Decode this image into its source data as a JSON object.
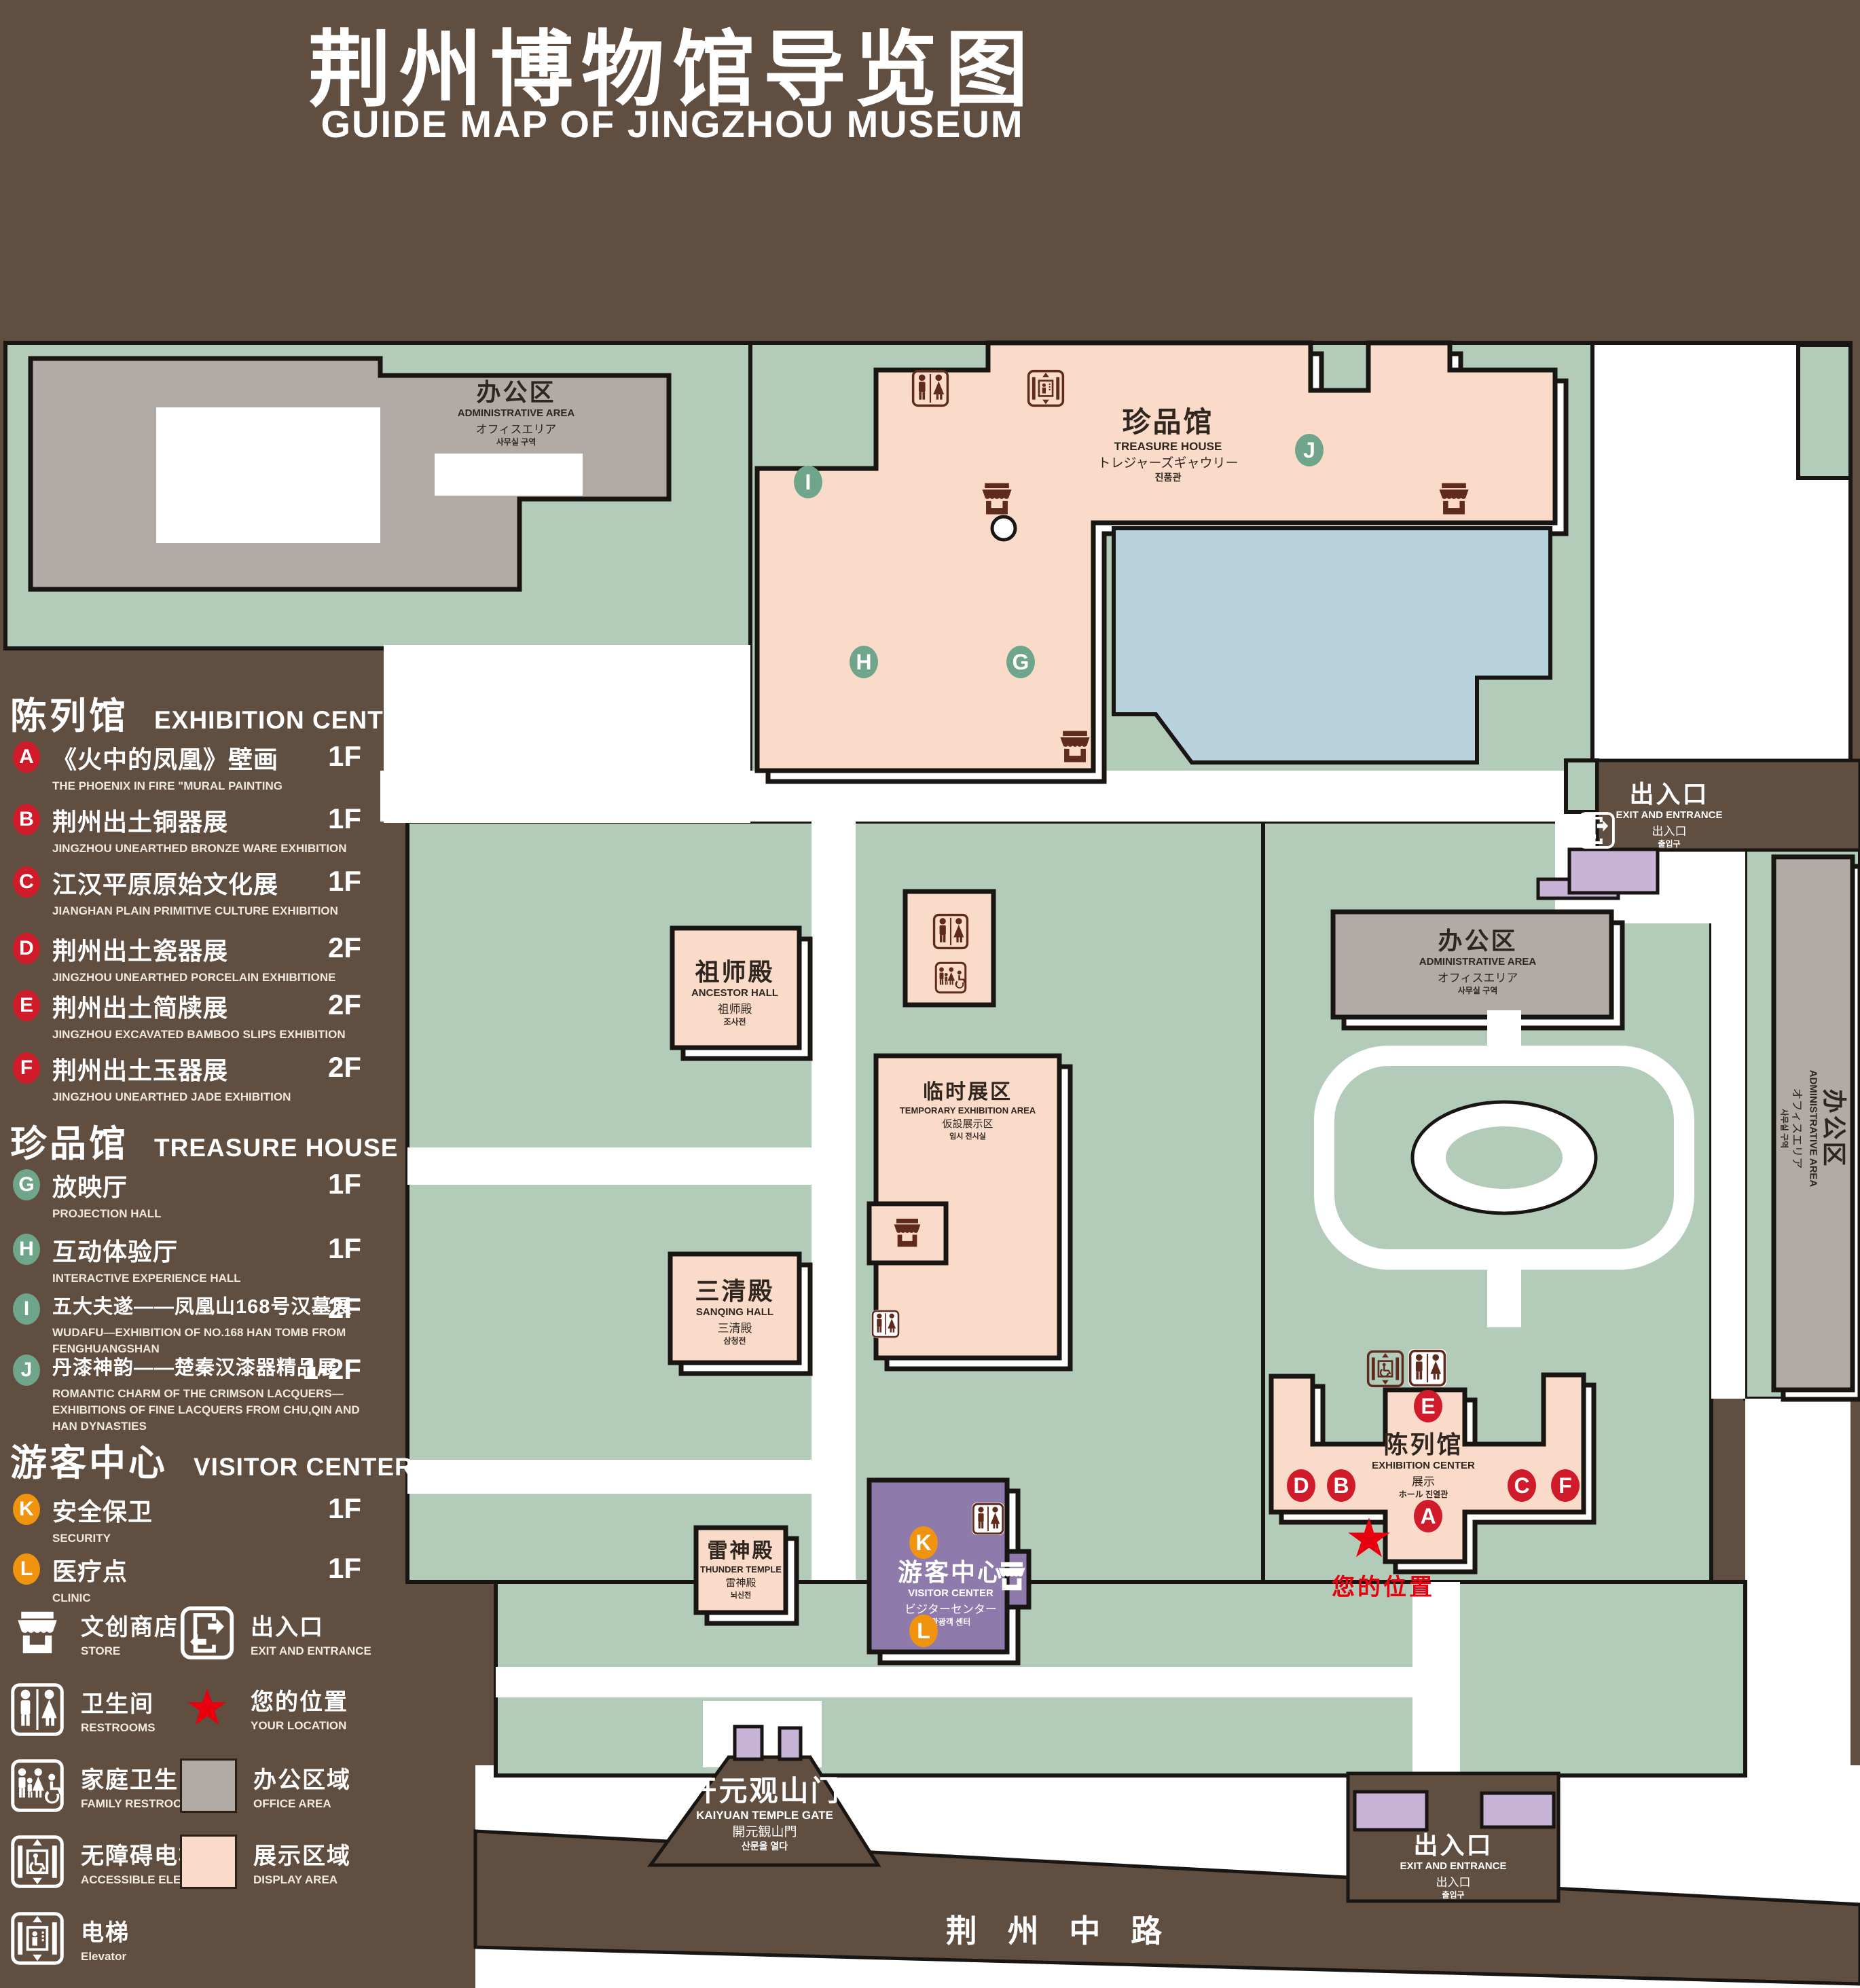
{
  "title": {
    "zh": "荆州博物馆导览图",
    "en": "GUIDE MAP OF JINGZHOU MUSEUM"
  },
  "legend": {
    "sections": [
      {
        "zh": "陈列馆",
        "en": "EXHIBITION CENTER",
        "items": [
          {
            "letter": "A",
            "zh": "《火中的凤凰》壁画",
            "en": "THE PHOENIX IN FIRE \"MURAL PAINTING",
            "floor": "1F"
          },
          {
            "letter": "B",
            "zh": "荆州出土铜器展",
            "en": "JINGZHOU UNEARTHED BRONZE WARE EXHIBITION",
            "floor": "1F"
          },
          {
            "letter": "C",
            "zh": "江汉平原原始文化展",
            "en": "JIANGHAN PLAIN PRIMITIVE CULTURE EXHIBITION",
            "floor": "1F"
          },
          {
            "letter": "D",
            "zh": "荆州出土瓷器展",
            "en": "JINGZHOU UNEARTHED PORCELAIN EXHIBITIONE",
            "floor": "2F"
          },
          {
            "letter": "E",
            "zh": "荆州出土简牍展",
            "en": "JINGZHOU EXCAVATED BAMBOO SLIPS EXHIBITION",
            "floor": "2F"
          },
          {
            "letter": "F",
            "zh": "荆州出土玉器展",
            "en": "JINGZHOU UNEARTHED JADE EXHIBITION",
            "floor": "2F"
          }
        ]
      },
      {
        "zh": "珍品馆",
        "en": "TREASURE HOUSE",
        "items": [
          {
            "letter": "G",
            "zh": "放映厅",
            "en": "PROJECTION HALL",
            "floor": "1F"
          },
          {
            "letter": "H",
            "zh": "互动体验厅",
            "en": "INTERACTIVE EXPERIENCE HALL",
            "floor": "1F"
          },
          {
            "letter": "I",
            "zh": "五大夫遂——凤凰山168号汉墓展",
            "en": "WUDAFU—EXHIBITION OF NO.168 HAN TOMB FROM FENGHUANGSHAN",
            "floor": "2F"
          },
          {
            "letter": "J",
            "zh": "丹漆神韵——楚秦汉漆器精品展",
            "en": "ROMANTIC CHARM OF THE CRIMSON LACQUERS—EXHIBITIONS OF FINE LACQUERS FROM CHU,QIN AND HAN DYNASTIES",
            "floor": "1-2F"
          }
        ]
      },
      {
        "zh": "游客中心",
        "en": "VISITOR CENTER",
        "items": [
          {
            "letter": "K",
            "zh": "安全保卫",
            "en": "SECURITY",
            "floor": "1F"
          },
          {
            "letter": "L",
            "zh": "医疗点",
            "en": "CLINIC",
            "floor": "1F"
          }
        ]
      }
    ],
    "symbols": [
      {
        "icon": "store-icon",
        "zh": "文创商店",
        "en": "STORE"
      },
      {
        "icon": "exit-icon",
        "zh": "出入口",
        "en": "EXIT AND ENTRANCE"
      },
      {
        "icon": "restroom-icon",
        "zh": "卫生间",
        "en": "RESTROOMS"
      },
      {
        "icon": "location-star-icon",
        "zh": "您的位置",
        "en": "YOUR LOCATION"
      },
      {
        "icon": "family-restroom-icon",
        "zh": "家庭卫生间",
        "en": "FAMILY RESTROOMS"
      },
      {
        "icon": "office-swatch",
        "zh": "办公区域",
        "en": "OFFICE AREA"
      },
      {
        "icon": "accessible-elevator-icon",
        "zh": "无障碍电梯",
        "en": "ACCESSIBLE ELEVATOR"
      },
      {
        "icon": "display-swatch",
        "zh": "展示区域",
        "en": "DISPLAY AREA"
      },
      {
        "icon": "elevator-icon",
        "zh": "电梯",
        "en": "Elevator"
      }
    ]
  },
  "map": {
    "buildings": {
      "admin_nw": {
        "zh": "办公区",
        "en": "ADMINISTRATIVE AREA",
        "ja": "オフィスエリア",
        "ko": "사무실 구역"
      },
      "treasure_house": {
        "zh": "珍品馆",
        "en": "TREASURE HOUSE",
        "ja": "トレジャーズギャウリー",
        "ko": "진품관"
      },
      "ancestor_hall": {
        "zh": "祖师殿",
        "en": "ANCESTOR HALL",
        "ja": "祖师殿",
        "ko": "조사전"
      },
      "temporary_exhibition": {
        "zh": "临时展区",
        "en": "TEMPORARY EXHIBITION AREA",
        "ja": "仮設展示区",
        "ko": "임시 전시실"
      },
      "admin_east": {
        "zh": "办公区",
        "en": "ADMINISTRATIVE AREA",
        "ja": "オフィスエリア",
        "ko": "사무실 구역"
      },
      "sanqing_hall": {
        "zh": "三清殿",
        "en": "SANQING HALL",
        "ja": "三清殿",
        "ko": "삼청전"
      },
      "thunder_temple": {
        "zh": "雷神殿",
        "en": "THUNDER TEMPLE",
        "ja": "雷神殿",
        "ko": "뇌신전"
      },
      "visitor_center": {
        "zh": "游客中心",
        "en": "VISITOR CENTER",
        "ja": "ビジターセンター",
        "ko": "관광객 센터"
      },
      "exhibition_center": {
        "zh": "陈列馆",
        "en": "EXHIBITION CENTER",
        "ja": "展示",
        "ko": "ホール 진열관"
      },
      "admin_se": {
        "zh": "办公区",
        "en": "ADMINISTRATIVE AREA",
        "ja": "オフィスエリア",
        "ko": "사무실 구역"
      }
    },
    "gate": {
      "zh": "开元观山门",
      "en": "KAIYUAN TEMPLE GATE",
      "ja": "開元観山門",
      "ko": "산문을 열다"
    },
    "exit_northeast": {
      "zh": "出入口",
      "en": "EXIT AND ENTRANCE",
      "ja": "出入口",
      "ko": "출입구"
    },
    "exit_south": {
      "zh": "出入口",
      "en": "EXIT AND ENTRANCE",
      "ja": "出入口",
      "ko": "출입구"
    },
    "road": {
      "name": "荆 州 中 路"
    },
    "your_location": {
      "zh": "您的位置"
    },
    "markers": [
      "A",
      "B",
      "C",
      "D",
      "E",
      "F",
      "G",
      "H",
      "I",
      "J",
      "K",
      "L"
    ]
  },
  "colors": {
    "background_brown": "#604e40",
    "lawn_green": "#b3ccba",
    "display_area_pink": "#fadbc9",
    "office_area_gray": "#b2aaa4",
    "visitor_center_purple": "#8e7bab",
    "gate_purple": "#c8b4d6",
    "pond_blue": "#b9d3de",
    "marker_red": "#cf1b2a",
    "marker_green": "#6fa58a",
    "marker_orange": "#f0930f",
    "location_red": "#e8000f",
    "map_icon_brown": "#5e2b1e"
  }
}
